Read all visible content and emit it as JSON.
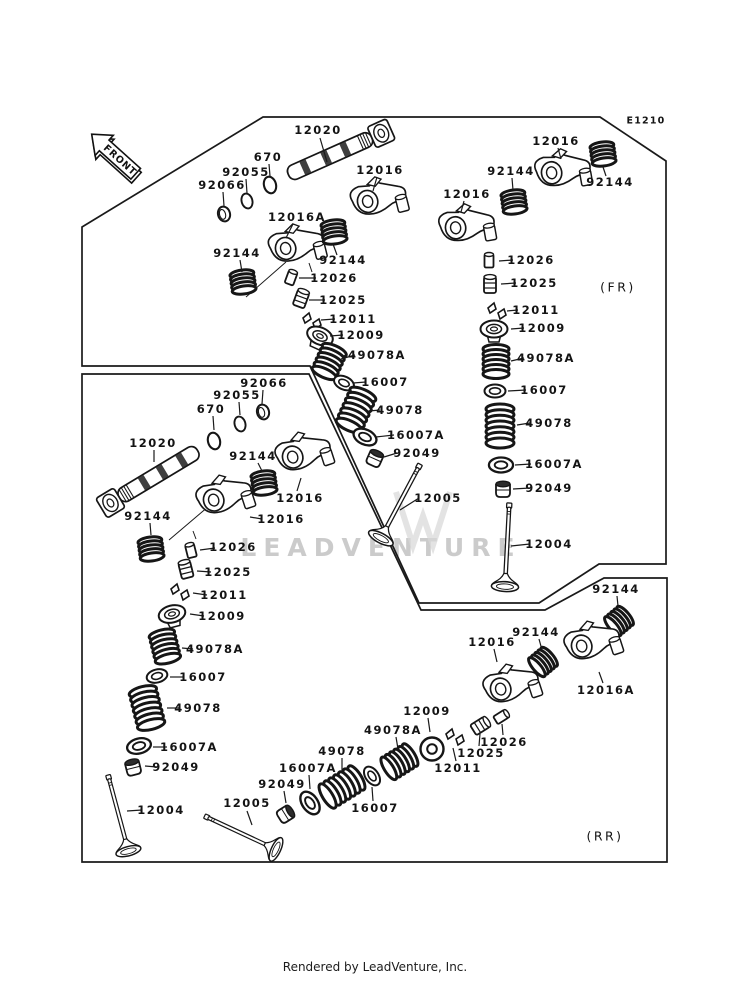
{
  "meta": {
    "diagram_code": "E1210",
    "front_arrow_label": "FRONT",
    "fr_zone_label": "(FR)",
    "rr_zone_label": "(RR)",
    "watermark": "LEADVENTURE",
    "footer": "Rendered by LeadVenture, Inc.",
    "ink_color": "#1a1a1a",
    "watermark_color": "#cbcbcb"
  },
  "panels": [
    {
      "name": "fr-panel",
      "points": "82,227 263,117 600,117 666,161 666,564 599,564 539,603 419,603 310,366 82,366"
    },
    {
      "name": "rr-panel",
      "points": "82,374 309,374 421,610 545,610 604,578 667,578 667,862 82,862"
    }
  ],
  "texts": [
    {
      "t": "E1210",
      "x": 646,
      "y": 121,
      "cls": "code",
      "name": "diagram-code"
    },
    {
      "t": "(FR)",
      "x": 618,
      "y": 287,
      "cls": "zone",
      "name": "fr-zone-label"
    },
    {
      "t": "(RR)",
      "x": 605,
      "y": 836,
      "cls": "zone",
      "name": "rr-zone-label"
    }
  ],
  "arrow": {
    "x": 116,
    "y": 155,
    "r": 42,
    "s": 0.8
  },
  "axis_lines": [
    [
      286,
      262,
      246,
      297
    ],
    [
      209,
      506,
      169,
      540
    ],
    [
      309,
      263,
      312,
      272
    ],
    [
      193,
      531,
      196,
      539
    ]
  ],
  "labels": [
    {
      "t": "12020",
      "x": 318,
      "y": 130,
      "l": [
        320,
        138,
        327,
        162
      ]
    },
    {
      "t": "670",
      "x": 268,
      "y": 157,
      "l": [
        269,
        164,
        270,
        176
      ]
    },
    {
      "t": "92055",
      "x": 246,
      "y": 172,
      "l": [
        246,
        179,
        247,
        193
      ]
    },
    {
      "t": "92066",
      "x": 222,
      "y": 185,
      "l": [
        223,
        192,
        224,
        206
      ]
    },
    {
      "t": "12016A",
      "x": 297,
      "y": 217,
      "l": [
        293,
        224,
        286,
        238
      ]
    },
    {
      "t": "12016",
      "x": 380,
      "y": 170,
      "l": [
        377,
        177,
        373,
        191
      ]
    },
    {
      "t": "92144",
      "x": 237,
      "y": 253,
      "l": [
        240,
        260,
        242,
        272
      ]
    },
    {
      "t": "92144",
      "x": 343,
      "y": 260,
      "l": [
        337,
        255,
        333,
        244
      ]
    },
    {
      "t": "12026",
      "x": 334,
      "y": 278,
      "l": [
        316,
        278,
        299,
        278
      ]
    },
    {
      "t": "12025",
      "x": 343,
      "y": 300,
      "l": [
        325,
        300,
        309,
        300
      ]
    },
    {
      "t": "12011",
      "x": 353,
      "y": 319,
      "l": [
        335,
        319,
        321,
        320
      ]
    },
    {
      "t": "12009",
      "x": 361,
      "y": 335,
      "l": [
        343,
        335,
        330,
        336
      ]
    },
    {
      "t": "49078A",
      "x": 377,
      "y": 355,
      "l": [
        355,
        355,
        341,
        359
      ]
    },
    {
      "t": "16007",
      "x": 385,
      "y": 382,
      "l": [
        366,
        382,
        353,
        383
      ]
    },
    {
      "t": "49078",
      "x": 400,
      "y": 410,
      "l": [
        380,
        410,
        369,
        411
      ]
    },
    {
      "t": "16007A",
      "x": 416,
      "y": 435,
      "l": [
        394,
        435,
        376,
        437
      ]
    },
    {
      "t": "92049",
      "x": 417,
      "y": 453,
      "l": [
        397,
        453,
        384,
        457
      ]
    },
    {
      "t": "12005",
      "x": 438,
      "y": 498,
      "l": [
        419,
        498,
        400,
        510
      ]
    },
    {
      "t": "12016",
      "x": 467,
      "y": 194,
      "l": [
        464,
        201,
        461,
        212
      ]
    },
    {
      "t": "12016",
      "x": 556,
      "y": 141,
      "l": [
        558,
        148,
        561,
        159
      ]
    },
    {
      "t": "92144",
      "x": 511,
      "y": 171,
      "l": [
        512,
        178,
        513,
        190
      ]
    },
    {
      "t": "92144",
      "x": 610,
      "y": 182,
      "l": [
        606,
        176,
        603,
        167
      ]
    },
    {
      "t": "12026",
      "x": 531,
      "y": 260,
      "l": [
        513,
        260,
        499,
        261
      ]
    },
    {
      "t": "12025",
      "x": 534,
      "y": 283,
      "l": [
        516,
        283,
        501,
        284
      ]
    },
    {
      "t": "12011",
      "x": 536,
      "y": 310,
      "l": [
        518,
        310,
        507,
        311
      ]
    },
    {
      "t": "12009",
      "x": 542,
      "y": 328,
      "l": [
        524,
        328,
        511,
        329
      ]
    },
    {
      "t": "49078A",
      "x": 546,
      "y": 358,
      "l": [
        524,
        358,
        511,
        361
      ]
    },
    {
      "t": "16007",
      "x": 544,
      "y": 390,
      "l": [
        526,
        390,
        508,
        391
      ]
    },
    {
      "t": "49078",
      "x": 549,
      "y": 423,
      "l": [
        530,
        423,
        517,
        425
      ]
    },
    {
      "t": "16007A",
      "x": 554,
      "y": 464,
      "l": [
        531,
        464,
        515,
        465
      ]
    },
    {
      "t": "92049",
      "x": 549,
      "y": 488,
      "l": [
        530,
        488,
        513,
        489
      ]
    },
    {
      "t": "12004",
      "x": 549,
      "y": 544,
      "l": [
        530,
        544,
        511,
        546
      ]
    },
    {
      "t": "92066",
      "x": 264,
      "y": 383,
      "l": [
        263,
        390,
        262,
        404
      ]
    },
    {
      "t": "92055",
      "x": 237,
      "y": 395,
      "l": [
        239,
        402,
        240,
        415
      ]
    },
    {
      "t": "670",
      "x": 211,
      "y": 409,
      "l": [
        213,
        416,
        214,
        430
      ]
    },
    {
      "t": "12020",
      "x": 153,
      "y": 443,
      "l": [
        154,
        450,
        154,
        462
      ]
    },
    {
      "t": "92144",
      "x": 148,
      "y": 516,
      "l": [
        150,
        523,
        151,
        535
      ]
    },
    {
      "t": "12016",
      "x": 300,
      "y": 498,
      "l": [
        297,
        491,
        301,
        478
      ]
    },
    {
      "t": "12016",
      "x": 281,
      "y": 519,
      "l": [
        262,
        519,
        250,
        517
      ]
    },
    {
      "t": "92144",
      "x": 253,
      "y": 456,
      "l": [
        258,
        463,
        262,
        471
      ]
    },
    {
      "t": "12026",
      "x": 233,
      "y": 547,
      "l": [
        215,
        548,
        200,
        550
      ]
    },
    {
      "t": "12025",
      "x": 228,
      "y": 572,
      "l": [
        211,
        572,
        197,
        571
      ]
    },
    {
      "t": "12011",
      "x": 224,
      "y": 595,
      "l": [
        207,
        595,
        193,
        593
      ]
    },
    {
      "t": "12009",
      "x": 222,
      "y": 616,
      "l": [
        204,
        616,
        190,
        614
      ]
    },
    {
      "t": "49078A",
      "x": 215,
      "y": 649,
      "l": [
        193,
        649,
        182,
        648
      ]
    },
    {
      "t": "16007",
      "x": 203,
      "y": 677,
      "l": [
        184,
        677,
        170,
        677
      ]
    },
    {
      "t": "49078",
      "x": 198,
      "y": 708,
      "l": [
        179,
        708,
        167,
        708
      ]
    },
    {
      "t": "16007A",
      "x": 189,
      "y": 747,
      "l": [
        167,
        747,
        153,
        747
      ]
    },
    {
      "t": "92049",
      "x": 176,
      "y": 767,
      "l": [
        157,
        767,
        145,
        766
      ]
    },
    {
      "t": "12004",
      "x": 161,
      "y": 810,
      "l": [
        142,
        810,
        127,
        811
      ]
    },
    {
      "t": "12005",
      "x": 247,
      "y": 803,
      "l": [
        247,
        811,
        252,
        825
      ]
    },
    {
      "t": "92049",
      "x": 282,
      "y": 784,
      "l": [
        284,
        791,
        286,
        803
      ]
    },
    {
      "t": "16007A",
      "x": 308,
      "y": 768,
      "l": [
        309,
        775,
        310,
        789
      ]
    },
    {
      "t": "49078",
      "x": 342,
      "y": 751,
      "l": [
        342,
        758,
        342,
        771
      ]
    },
    {
      "t": "16007",
      "x": 375,
      "y": 808,
      "l": [
        373,
        801,
        372,
        787
      ]
    },
    {
      "t": "49078A",
      "x": 393,
      "y": 730,
      "l": [
        396,
        737,
        398,
        749
      ]
    },
    {
      "t": "12009",
      "x": 427,
      "y": 711,
      "l": [
        428,
        718,
        430,
        732
      ]
    },
    {
      "t": "12011",
      "x": 458,
      "y": 768,
      "l": [
        456,
        761,
        453,
        748
      ]
    },
    {
      "t": "12025",
      "x": 481,
      "y": 753,
      "l": [
        479,
        746,
        480,
        734
      ]
    },
    {
      "t": "12026",
      "x": 504,
      "y": 742,
      "l": [
        503,
        735,
        502,
        724
      ]
    },
    {
      "t": "12016",
      "x": 492,
      "y": 642,
      "l": [
        494,
        649,
        497,
        662
      ]
    },
    {
      "t": "92144",
      "x": 536,
      "y": 632,
      "l": [
        539,
        639,
        542,
        650
      ]
    },
    {
      "t": "92144",
      "x": 616,
      "y": 589,
      "l": [
        617,
        596,
        618,
        606
      ]
    },
    {
      "t": "12016A",
      "x": 606,
      "y": 690,
      "l": [
        603,
        683,
        599,
        672
      ]
    }
  ],
  "parts": [
    {
      "k": "camshaft",
      "n": "12020",
      "x": 337,
      "y": 153,
      "r": -24,
      "s": 0.95
    },
    {
      "k": "oring",
      "n": "670",
      "x": 270,
      "y": 185,
      "r": -15,
      "s": 0.8
    },
    {
      "k": "oring",
      "n": "92055",
      "x": 247,
      "y": 201,
      "r": -15,
      "s": 0.72
    },
    {
      "k": "disc",
      "n": "92066",
      "x": 224,
      "y": 214,
      "r": -15,
      "s": 1
    },
    {
      "k": "rocker",
      "n": "12016A",
      "x": 295,
      "y": 248,
      "r": -14,
      "s": 0.92
    },
    {
      "k": "rocker",
      "n": "12016",
      "x": 377,
      "y": 201,
      "r": -14,
      "s": 0.92
    },
    {
      "k": "spring-s",
      "n": "92144",
      "x": 243,
      "y": 282,
      "r": -8,
      "s": 1
    },
    {
      "k": "spring-s",
      "n": "92144",
      "x": 334,
      "y": 232,
      "r": -8,
      "s": 1
    },
    {
      "k": "cyl",
      "n": "12026",
      "x": 291,
      "y": 278,
      "r": 20,
      "s": 1
    },
    {
      "k": "lifter",
      "n": "12025",
      "x": 301,
      "y": 299,
      "r": 20,
      "s": 1
    },
    {
      "k": "keepers",
      "n": "12011",
      "x": 312,
      "y": 321,
      "r": 0,
      "s": 1
    },
    {
      "k": "retainer",
      "n": "12009",
      "x": 320,
      "y": 336,
      "r": 24,
      "s": 1
    },
    {
      "k": "spring-m",
      "n": "49078A",
      "x": 329,
      "y": 362,
      "r": 24,
      "s": 1
    },
    {
      "k": "washer",
      "n": "16007",
      "x": 344,
      "y": 383,
      "r": 24,
      "s": 1
    },
    {
      "k": "spring-l",
      "n": "49078",
      "x": 356,
      "y": 410,
      "r": 24,
      "s": 1
    },
    {
      "k": "washer",
      "n": "16007A",
      "x": 365,
      "y": 437,
      "r": 24,
      "s": 1.15
    },
    {
      "k": "seal",
      "n": "92049",
      "x": 375,
      "y": 458,
      "r": 24,
      "s": 1
    },
    {
      "k": "valve",
      "n": "12005",
      "x": 399,
      "y": 504,
      "r": 28,
      "s": 0.85
    },
    {
      "k": "rocker",
      "n": "12016",
      "x": 465,
      "y": 228,
      "r": -10,
      "s": 0.92
    },
    {
      "k": "rocker",
      "n": "12016",
      "x": 561,
      "y": 173,
      "r": -10,
      "s": 0.92
    },
    {
      "k": "spring-s",
      "n": "92144",
      "x": 514,
      "y": 202,
      "r": -8,
      "s": 1
    },
    {
      "k": "spring-s",
      "n": "92144",
      "x": 603,
      "y": 154,
      "r": -8,
      "s": 1
    },
    {
      "k": "cyl",
      "n": "12026",
      "x": 489,
      "y": 261,
      "r": 0,
      "s": 1
    },
    {
      "k": "lifter",
      "n": "12025",
      "x": 490,
      "y": 285,
      "r": 0,
      "s": 1
    },
    {
      "k": "keepers",
      "n": "12011",
      "x": 497,
      "y": 311,
      "r": 0,
      "s": 1
    },
    {
      "k": "retainer",
      "n": "12009",
      "x": 494,
      "y": 329,
      "r": 0,
      "s": 1
    },
    {
      "k": "spring-m",
      "n": "49078A",
      "x": 496,
      "y": 362,
      "r": 0,
      "s": 1
    },
    {
      "k": "washer",
      "n": "16007",
      "x": 495,
      "y": 391,
      "r": 0,
      "s": 1
    },
    {
      "k": "spring-l",
      "n": "49078",
      "x": 500,
      "y": 426,
      "r": 0,
      "s": 1
    },
    {
      "k": "washer",
      "n": "16007A",
      "x": 501,
      "y": 465,
      "r": 0,
      "s": 1.15
    },
    {
      "k": "seal",
      "n": "92049",
      "x": 503,
      "y": 489,
      "r": 0,
      "s": 1
    },
    {
      "k": "valve",
      "n": "12004",
      "x": 507,
      "y": 548,
      "r": 3,
      "s": 0.85
    },
    {
      "k": "disc",
      "n": "92066",
      "x": 263,
      "y": 412,
      "r": -15,
      "s": 1
    },
    {
      "k": "oring",
      "n": "92055",
      "x": 240,
      "y": 424,
      "r": -15,
      "s": 0.72
    },
    {
      "k": "oring",
      "n": "670",
      "x": 214,
      "y": 441,
      "r": -15,
      "s": 0.8
    },
    {
      "k": "camshaft",
      "n": "12020",
      "x": 152,
      "y": 478,
      "r": 149,
      "s": 0.95
    },
    {
      "k": "spring-s",
      "n": "92144",
      "x": 151,
      "y": 549,
      "r": -8,
      "s": 1
    },
    {
      "k": "rocker",
      "n": "12016",
      "x": 302,
      "y": 456,
      "r": -18,
      "s": 0.92
    },
    {
      "k": "rocker",
      "n": "12016",
      "x": 223,
      "y": 499,
      "r": -18,
      "s": 0.92
    },
    {
      "k": "spring-s",
      "n": "92144",
      "x": 264,
      "y": 483,
      "r": -8,
      "s": 1
    },
    {
      "k": "cyl",
      "n": "12026",
      "x": 191,
      "y": 551,
      "r": -14,
      "s": 1
    },
    {
      "k": "lifter",
      "n": "12025",
      "x": 186,
      "y": 570,
      "r": -14,
      "s": 1
    },
    {
      "k": "keepers",
      "n": "12011",
      "x": 180,
      "y": 592,
      "r": 0,
      "s": 1
    },
    {
      "k": "retainer",
      "n": "12009",
      "x": 172,
      "y": 614,
      "r": -14,
      "s": 1
    },
    {
      "k": "spring-m",
      "n": "49078A",
      "x": 165,
      "y": 647,
      "r": -14,
      "s": 1
    },
    {
      "k": "washer",
      "n": "16007",
      "x": 157,
      "y": 676,
      "r": -14,
      "s": 1
    },
    {
      "k": "spring-l",
      "n": "49078",
      "x": 147,
      "y": 708,
      "r": -14,
      "s": 1
    },
    {
      "k": "washer",
      "n": "16007A",
      "x": 139,
      "y": 746,
      "r": -14,
      "s": 1.15
    },
    {
      "k": "seal",
      "n": "92049",
      "x": 133,
      "y": 767,
      "r": -14,
      "s": 1
    },
    {
      "k": "valve",
      "n": "12004",
      "x": 119,
      "y": 816,
      "r": -15,
      "s": 0.8
    },
    {
      "k": "valve",
      "n": "12005",
      "x": 243,
      "y": 834,
      "r": -65,
      "s": 0.8
    },
    {
      "k": "seal",
      "n": "92049",
      "x": 286,
      "y": 814,
      "r": 58,
      "s": 1
    },
    {
      "k": "washer",
      "n": "16007A",
      "x": 310,
      "y": 803,
      "r": 55,
      "s": 1.2
    },
    {
      "k": "spring-l",
      "n": "49078",
      "x": 342,
      "y": 787,
      "r": 58,
      "s": 1
    },
    {
      "k": "washer",
      "n": "16007",
      "x": 372,
      "y": 776,
      "r": 55,
      "s": 1
    },
    {
      "k": "spring-m",
      "n": "49078A",
      "x": 399,
      "y": 762,
      "r": 58,
      "s": 1
    },
    {
      "k": "ringface",
      "n": "12009",
      "x": 432,
      "y": 749,
      "r": 0,
      "s": 1
    },
    {
      "k": "keepers",
      "n": "12011",
      "x": 455,
      "y": 737,
      "r": 0,
      "s": 1
    },
    {
      "k": "lifter",
      "n": "12025",
      "x": 480,
      "y": 726,
      "r": 58,
      "s": 1
    },
    {
      "k": "cyl",
      "n": "12026",
      "x": 501,
      "y": 717,
      "r": 58,
      "s": 1
    },
    {
      "k": "rocker",
      "n": "12016",
      "x": 510,
      "y": 688,
      "r": -18,
      "s": 0.92
    },
    {
      "k": "spring-s",
      "n": "92144",
      "x": 543,
      "y": 662,
      "r": 50,
      "s": 1
    },
    {
      "k": "spring-s",
      "n": "92144",
      "x": 619,
      "y": 621,
      "r": 50,
      "s": 1
    },
    {
      "k": "rocker",
      "n": "12016A",
      "x": 591,
      "y": 645,
      "r": -18,
      "s": 0.92
    }
  ]
}
